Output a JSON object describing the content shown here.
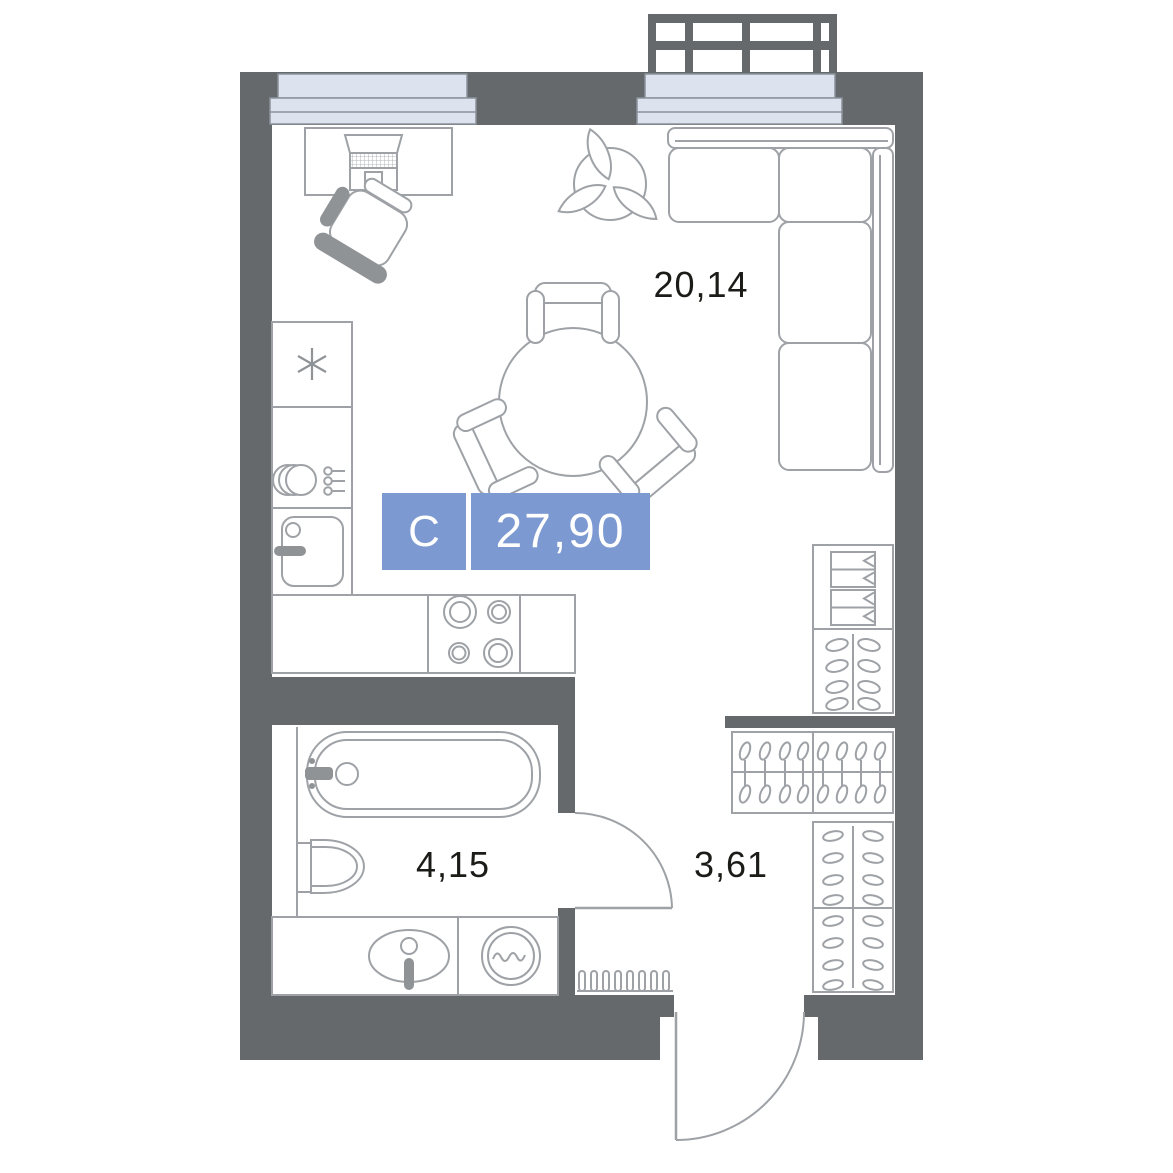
{
  "plan": {
    "kind": "studio-apartment-floor-plan",
    "badge": {
      "type_label": "С",
      "area": "27,90"
    },
    "rooms": [
      {
        "id": "living-kitchen",
        "area": "20,14"
      },
      {
        "id": "bathroom",
        "area": "4,15"
      },
      {
        "id": "hallway",
        "area": "3,61"
      }
    ],
    "icons": [
      "balcony-railing-icon",
      "window-icon",
      "desk-laptop-icon",
      "office-chair-icon",
      "plant-icon",
      "corner-sofa-icon",
      "dining-table-icon",
      "dining-chair-icon",
      "refrigerator-snowflake-icon",
      "dish-rack-icon",
      "kitchen-sink-icon",
      "cooktop-icon",
      "bathtub-icon",
      "toilet-icon",
      "vanity-sink-icon",
      "washing-machine-icon",
      "wardrobe-drawers-icon",
      "wardrobe-hangers-icon",
      "door-swing-icon",
      "radiator-icon"
    ],
    "colors": {
      "wall": "#66696B",
      "furniture_outline": "#9EA2A6",
      "furniture_dark": "#8F9396",
      "window_fill": "#DCE3EF",
      "window_stroke": "#8C929B",
      "badge_background": "#7C99D1",
      "badge_text": "#FFFFFF",
      "label_text": "#1B1B18",
      "background": "#FFFFFF"
    }
  }
}
